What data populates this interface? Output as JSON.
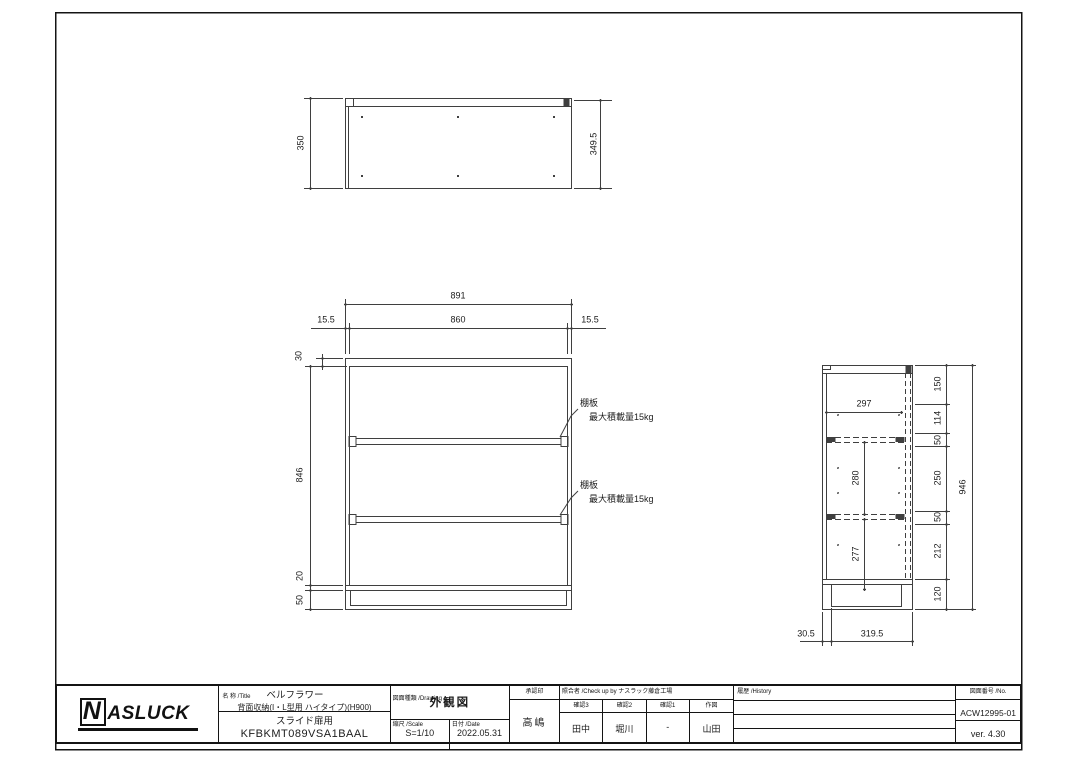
{
  "dims": {
    "top_view": {
      "height_left": "350",
      "height_right": "349.5"
    },
    "front": {
      "total_width": "891",
      "inner_width": "860",
      "edge_left": "15.5",
      "edge_right": "15.5",
      "top_panel": "30",
      "body_height": "846",
      "bottom_panel": "20",
      "base_height": "50"
    },
    "side": {
      "inner_width": "297",
      "shelf_spacing": "280",
      "lower_spacing": "277",
      "right_stack": [
        "150",
        "114",
        "50",
        "250",
        "50",
        "212",
        "120"
      ],
      "total_height": "946",
      "front_offset": "30.5",
      "depth": "319.5"
    }
  },
  "notes": {
    "shelf": {
      "title": "棚板",
      "capacity": "最大積載量15kg"
    }
  },
  "title_block": {
    "logo_n": "N",
    "logo_rest": "ASLUCK",
    "title_label": "名 称 /Title",
    "product_name": "ベルフラワー",
    "product_desc": "背面収納(I・L型用 ハイタイプ)(H900)",
    "product_type": "スライド扉用",
    "product_code": "KFBKMT089VSA1BAAL",
    "drawing_label": "図面種類 /Drawing",
    "drawing_type": "外観図",
    "scale_label": "縮尺 /Scale",
    "scale_value": "S=1/10",
    "date_label": "日付 /Date",
    "date_value": "2022.05.31",
    "approval_label": "承認印",
    "approval_name": "高嶋",
    "check_label": "照合者 /Check up by ナスラック藤倉工場",
    "check_cols": [
      {
        "label": "確認3",
        "value": "田中"
      },
      {
        "label": "確認2",
        "value": "堀川"
      },
      {
        "label": "確認1",
        "value": "-"
      },
      {
        "label": "作図",
        "value": "山田"
      }
    ],
    "history_label": "履歴 /History",
    "number_label": "図面番号 /No.",
    "number_value": "ACW12995-01",
    "version": "ver. 4.30"
  }
}
